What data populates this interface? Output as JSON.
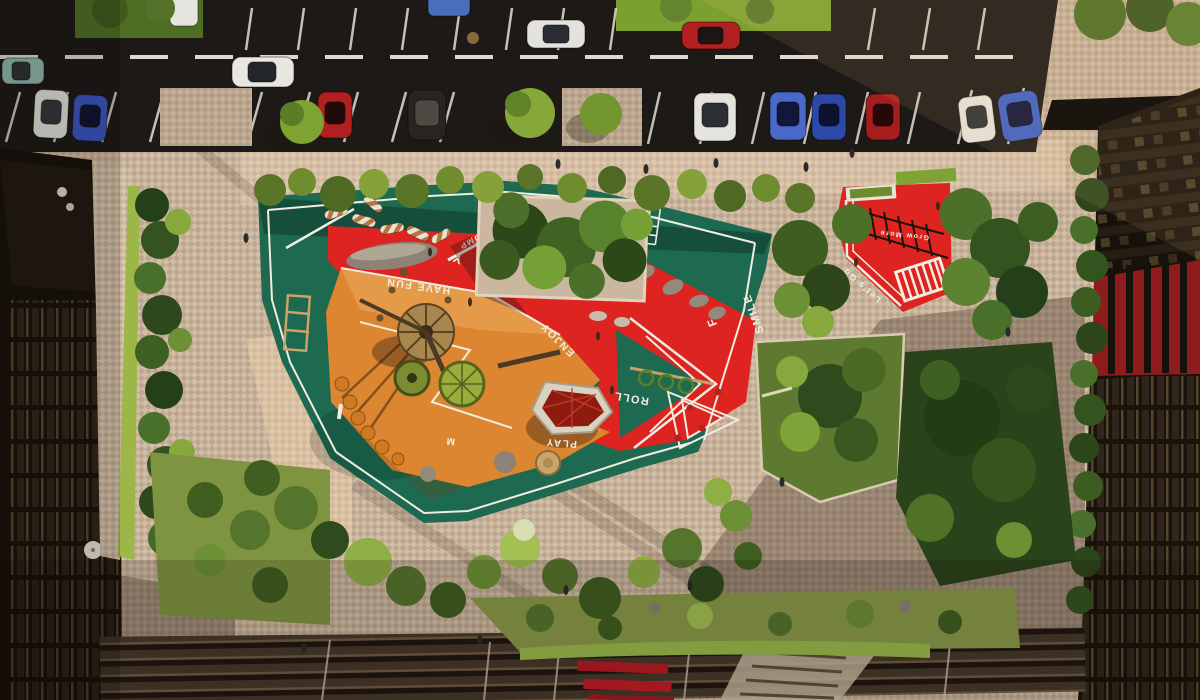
{
  "scene": {
    "kind": "aerial-render",
    "subject": "courtyard playground between residential buildings with street parking above and amphitheater steps below"
  },
  "markings": {
    "jump": "JUMP",
    "pump_pump": "PUMP-PUMP",
    "have_fun": "HAVE FUN",
    "enjoy": "ENJOY",
    "smile": "SMILE",
    "roll": "ROLL",
    "play": "PLAY",
    "lets_go": "Let's Go",
    "grow_more": "Grow More",
    "letter_y": "Y",
    "letter_f": "F",
    "letter_m": "M"
  },
  "palette": {
    "surface_green": "#1d6a50",
    "surface_green_dark": "#14523d",
    "surface_red": "#de2420",
    "surface_orange": "#dd8631",
    "line_white": "#f2ede1",
    "asphalt": "#1c1916",
    "pavement": "#d2bda6",
    "pavement_sunlit": "#e7d2b8",
    "grass": "#76982e",
    "foliage_dark": "#2f4a1a",
    "foliage_mid": "#55742c",
    "foliage_bright": "#8fae3f",
    "building_dark": "#171209",
    "panel_red": "#8e1c1c",
    "bench_red": "#c01d24",
    "boulder_gray": "#8d8276",
    "equipment_tan": "#b08a4f"
  },
  "vehicles": {
    "car_colors": [
      "#8fb5ad",
      "#e8e6e0",
      "#4a6fba",
      "#e4e2dc",
      "#b32020",
      "#dfe0da",
      "#3b55c0",
      "#b02020",
      "#23221f",
      "#e5e3dd",
      "#4a68c8",
      "#2c49a8",
      "#a61d1d",
      "#e2e0da",
      "#3d5fc2"
    ]
  }
}
